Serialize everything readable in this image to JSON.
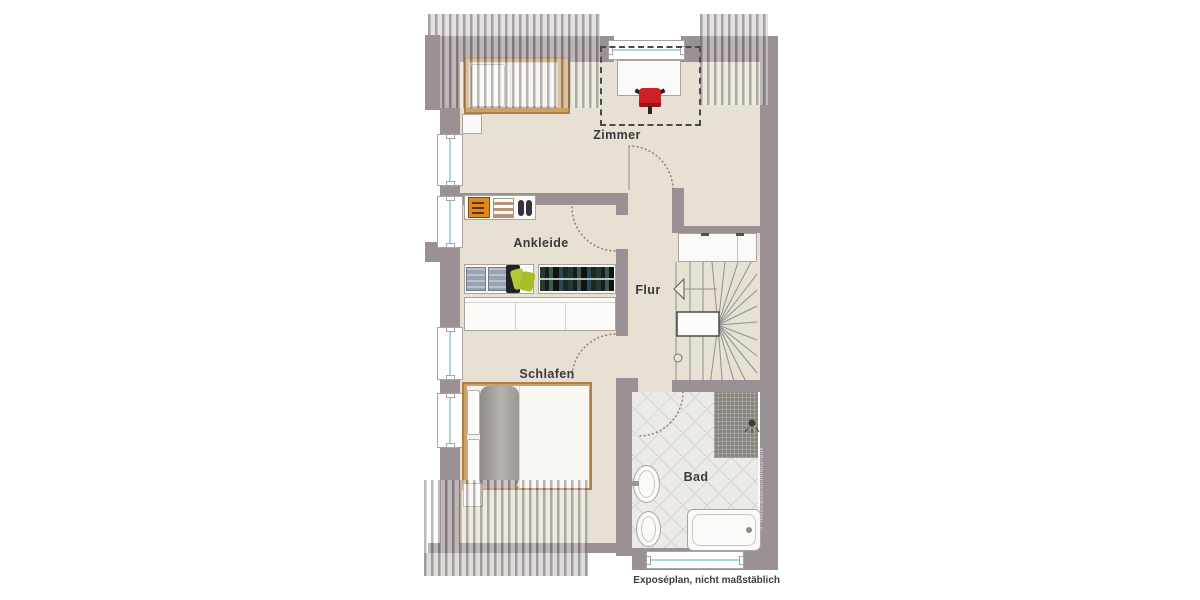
{
  "caption": "Exposéplan, nicht maßstäblich",
  "watermark": "⌂ IllustrationsImmoGrafik",
  "rooms": [
    {
      "label": "Zimmer"
    },
    {
      "label": "Ankleide"
    },
    {
      "label": "Flur"
    },
    {
      "label": "Schlafen"
    },
    {
      "label": "Bad"
    }
  ],
  "fixtures": [
    "single-bed",
    "desk",
    "desk-chair",
    "shelf",
    "clothes-rail",
    "wardrobe",
    "double-bed",
    "nightstand",
    "staircase",
    "closet",
    "sink",
    "toilet",
    "bathtub",
    "shower",
    "window",
    "door-swing",
    "roof-hatching"
  ],
  "colors": {
    "wall": "#9b9094",
    "floor": "#e6e1d3",
    "tile": "#eceae6",
    "glass": "#a8d8dc",
    "wood_frame": "#b07f47",
    "wood_fill": "#c9a169",
    "accent_red": "#cb2127",
    "accent_orange": "#e08a1d",
    "door_arc": "#a6766b"
  }
}
